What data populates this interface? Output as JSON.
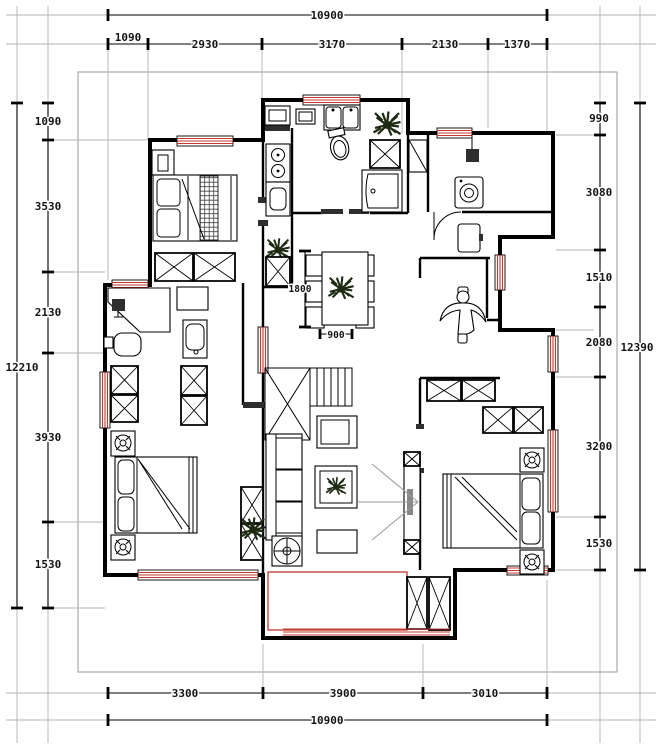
{
  "drawing_type": "apartment floor plan",
  "colors": {
    "wall": "#000000",
    "window_red": "#c0392b",
    "construction_gray": "#b3b3b3"
  },
  "dims": {
    "top_total": "10900",
    "top_chain": [
      "1090",
      "2930",
      "3170",
      "2130",
      "1370"
    ],
    "bottom_chain": [
      "3300",
      "3900",
      "3010"
    ],
    "bottom_total": "10900",
    "left_chain": [
      "1090",
      "3530",
      "2130",
      "3930",
      "1530"
    ],
    "left_total": "12210",
    "right_chain": [
      "990",
      "3080",
      "1510",
      "2080",
      "3200",
      "1530"
    ],
    "right_total": "12390",
    "dining_length": "1800",
    "dining_width": "900"
  }
}
